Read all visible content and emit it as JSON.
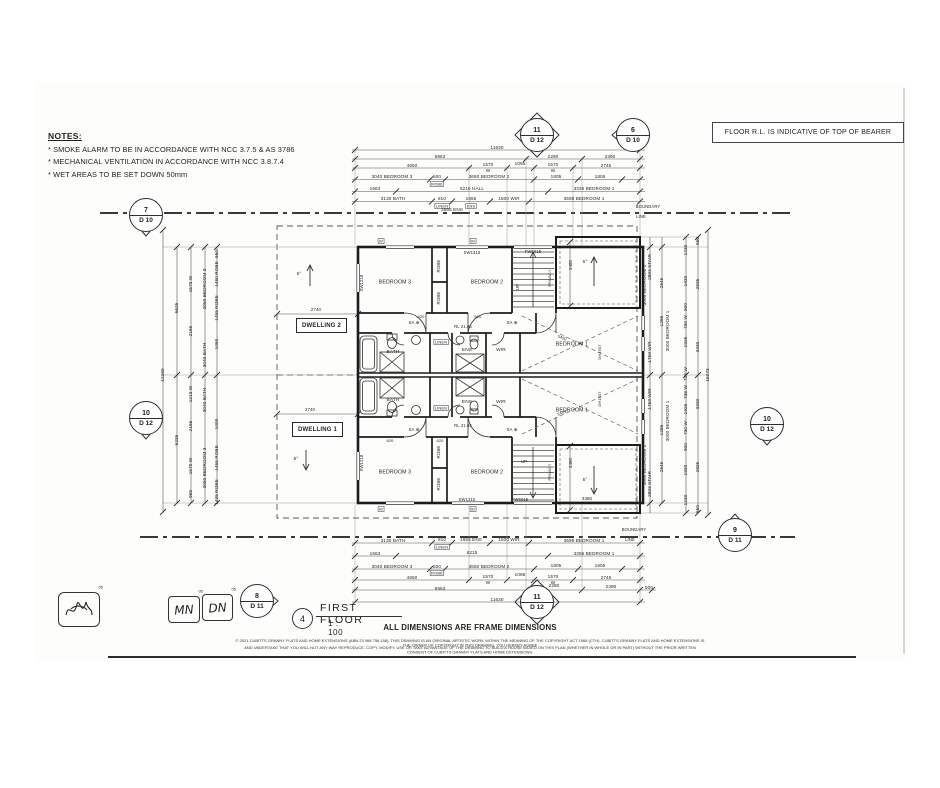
{
  "notes": {
    "title": "NOTES:",
    "lines": [
      "* SMOKE ALARM TO BE IN ACCORDANCE WITH NCC 3.7.5 & AS 3786",
      "* MECHANICAL VENTILATION IN ACCORDANCE WITH NCC 3.8.7.4",
      "* WET AREAS TO BE SET DOWN 50mm"
    ]
  },
  "floor_note": "FLOOR R.L. IS INDICATIVE OF TOP OF BEARER",
  "markers": [
    {
      "num": "11",
      "sheet": "D 12"
    },
    {
      "num": "6",
      "sheet": "D 10"
    },
    {
      "num": "7",
      "sheet": "D 10"
    },
    {
      "num": "10",
      "sheet": "D 12"
    },
    {
      "num": "10",
      "sheet": "D 12"
    },
    {
      "num": "9",
      "sheet": "D 11"
    },
    {
      "num": "11",
      "sheet": "D 12"
    },
    {
      "num": "8",
      "sheet": "D 11"
    }
  ],
  "plan": {
    "dwelling1": "DWELLING 1",
    "dwelling2": "DWELLING 2"
  },
  "stamps": {
    "initials_1": "MN",
    "initials_2": "DN",
    "tag": "05"
  },
  "title_block": {
    "number": "4",
    "title": "FIRST FLOOR",
    "scale": "1 : 100",
    "dims_note": "ALL DIMENSIONS ARE FRAME DIMENSIONS",
    "copyright_line1": "© 2021 CUBITTS GRANNY FLATS AND HOME EXTENSIONS (ABN 23 068 756 158). THIS DRAWING IS AN ORIGINAL ARTISTIC WORK WITHIN THE MEANING OF THE COPYRIGHT ACT 1968 (CTH). CUBITTS GRANNY FLATS AND HOME EXTENSIONS IS THE OWNER OF COPYRIGHT IN THIS DRAWING. YOU HEREBY AGREE",
    "copyright_line2": "AND UNDERTAKE THAT YOU WILL NOT ANY WAY REPRODUCE, COPY, MODIFY, USE OR TAKE ADVANTAGE OF THE DRAWING TO BUILD A HOUSE BASED ON THIS PLAN (WHETHER IN WHOLE OR IN PART) WITHOUT THE PRIOR WRITTEN CONSENT OF CUBITTS GRANNY FLATS AND HOME EXTENSIONS."
  },
  "annotations": [
    {
      "t": "11630",
      "x": 497,
      "y": 148
    },
    {
      "t": "6963",
      "x": 440,
      "y": 157
    },
    {
      "t": "2280",
      "x": 553,
      "y": 157
    },
    {
      "t": "2390",
      "x": 610,
      "y": 157
    },
    {
      "t": "4650",
      "x": 412,
      "y": 166
    },
    {
      "t": "1570",
      "x": 488,
      "y": 165
    },
    {
      "t": "W",
      "x": 488,
      "y": 171
    },
    {
      "t": "1095",
      "x": 520,
      "y": 164
    },
    {
      "t": "1570",
      "x": 553,
      "y": 165
    },
    {
      "t": "W",
      "x": 553,
      "y": 171
    },
    {
      "t": "2745",
      "x": 606,
      "y": 166
    },
    {
      "t": "3040 BEDROOM 3",
      "x": 392,
      "y": 177
    },
    {
      "t": "600",
      "x": 437,
      "y": 177
    },
    {
      "t": "ROBE",
      "x": 437,
      "y": 184,
      "bx": 1,
      "s": 4
    },
    {
      "t": "3650 BEDROOM 2",
      "x": 489,
      "y": 177
    },
    {
      "t": "1805",
      "x": 556,
      "y": 177
    },
    {
      "t": "1805",
      "x": 600,
      "y": 177
    },
    {
      "t": "1663",
      "x": 375,
      "y": 189
    },
    {
      "t": "6215 HALL",
      "x": 472,
      "y": 189
    },
    {
      "t": "3335 BEDROOM 1",
      "x": 594,
      "y": 189
    },
    {
      "t": "3130 BATH",
      "x": 393,
      "y": 199
    },
    {
      "t": "810",
      "x": 442,
      "y": 199
    },
    {
      "t": "LINEN",
      "x": 442,
      "y": 206,
      "bx": 1,
      "s": 4
    },
    {
      "t": "1555",
      "x": 471,
      "y": 199
    },
    {
      "t": "ENS",
      "x": 471,
      "y": 206,
      "bx": 1,
      "s": 4
    },
    {
      "t": "1600 WIR",
      "x": 509,
      "y": 199
    },
    {
      "t": "3695 BEDROOM 1",
      "x": 584,
      "y": 199
    },
    {
      "t": "2555 ENS",
      "x": 452,
      "y": 210
    },
    {
      "t": "3130 BATH",
      "x": 393,
      "y": 541
    },
    {
      "t": "810",
      "x": 442,
      "y": 540
    },
    {
      "t": "LINEN",
      "x": 442,
      "y": 547,
      "bx": 1,
      "s": 4
    },
    {
      "t": "1655 ENS",
      "x": 471,
      "y": 540
    },
    {
      "t": "1600 WIR",
      "x": 509,
      "y": 540
    },
    {
      "t": "3695 BEDROOM 1",
      "x": 584,
      "y": 541
    },
    {
      "t": "1663",
      "x": 375,
      "y": 554
    },
    {
      "t": "6215",
      "x": 472,
      "y": 553
    },
    {
      "t": "3395 BEDROOM 1",
      "x": 594,
      "y": 554
    },
    {
      "t": "3040 BEDROOM 3",
      "x": 392,
      "y": 567
    },
    {
      "t": "600",
      "x": 437,
      "y": 567
    },
    {
      "t": "ROBE",
      "x": 437,
      "y": 573,
      "bx": 1,
      "s": 4
    },
    {
      "t": "3650 BEDROOM 2",
      "x": 489,
      "y": 567
    },
    {
      "t": "1805",
      "x": 556,
      "y": 566
    },
    {
      "t": "1805",
      "x": 600,
      "y": 566
    },
    {
      "t": "4650",
      "x": 412,
      "y": 578
    },
    {
      "t": "1570",
      "x": 488,
      "y": 577
    },
    {
      "t": "W",
      "x": 488,
      "y": 583
    },
    {
      "t": "1095",
      "x": 520,
      "y": 575
    },
    {
      "t": "1570",
      "x": 553,
      "y": 577
    },
    {
      "t": "W",
      "x": 553,
      "y": 583
    },
    {
      "t": "2745",
      "x": 606,
      "y": 578
    },
    {
      "t": "6963",
      "x": 440,
      "y": 589
    },
    {
      "t": "2280",
      "x": 554,
      "y": 586
    },
    {
      "t": "2390",
      "x": 611,
      "y": 587
    },
    {
      "t": "500",
      "x": 649,
      "y": 588
    },
    {
      "t": "11630",
      "x": 497,
      "y": 600
    },
    {
      "t": "12369",
      "x": 163,
      "y": 375,
      "r": -90
    },
    {
      "t": "6625",
      "x": 177,
      "y": 308,
      "r": -90
    },
    {
      "t": "6235",
      "x": 177,
      "y": 440,
      "r": -90
    },
    {
      "t": "560",
      "x": 217,
      "y": 254,
      "r": -90
    },
    {
      "t": "1480 ROBE",
      "x": 217,
      "y": 274,
      "r": -90
    },
    {
      "t": "1573 W",
      "x": 191,
      "y": 284,
      "r": -90
    },
    {
      "t": "3050 BEDROOM 3",
      "x": 205,
      "y": 289,
      "r": -90
    },
    {
      "t": "1455 ROBE",
      "x": 217,
      "y": 308,
      "r": -90
    },
    {
      "t": "2165",
      "x": 191,
      "y": 331,
      "r": -90
    },
    {
      "t": "1060",
      "x": 217,
      "y": 344,
      "r": -90
    },
    {
      "t": "3040 BATH",
      "x": 205,
      "y": 355,
      "r": -90
    },
    {
      "t": "1213 W",
      "x": 191,
      "y": 394,
      "r": -90
    },
    {
      "t": "3040 BATH",
      "x": 205,
      "y": 400,
      "r": -90
    },
    {
      "t": "1000",
      "x": 217,
      "y": 424,
      "r": -90
    },
    {
      "t": "2165",
      "x": 191,
      "y": 426,
      "r": -90
    },
    {
      "t": "1455 ROBE",
      "x": 217,
      "y": 458,
      "r": -90
    },
    {
      "t": "1570 W",
      "x": 191,
      "y": 466,
      "r": -90
    },
    {
      "t": "3050 BEDROOM 3",
      "x": 205,
      "y": 468,
      "r": -90
    },
    {
      "t": "1435 ROBE",
      "x": 217,
      "y": 492,
      "r": -90
    },
    {
      "t": "968",
      "x": 191,
      "y": 494,
      "r": -90
    },
    {
      "t": "15273",
      "x": 708,
      "y": 375,
      "r": -90
    },
    {
      "t": "650",
      "x": 698,
      "y": 241,
      "r": -90
    },
    {
      "t": "1230",
      "x": 686,
      "y": 250,
      "r": -90
    },
    {
      "t": "2893 STAIR",
      "x": 650,
      "y": 267,
      "r": -90
    },
    {
      "t": "3000 BEDROOM 2",
      "x": 645,
      "y": 285,
      "r": -90
    },
    {
      "t": "2845",
      "x": 662,
      "y": 283,
      "r": -90
    },
    {
      "t": "1930",
      "x": 686,
      "y": 281,
      "r": -90
    },
    {
      "t": "2835",
      "x": 698,
      "y": 284,
      "r": -90
    },
    {
      "t": "900",
      "x": 686,
      "y": 307,
      "r": -90
    },
    {
      "t": "1286",
      "x": 662,
      "y": 321,
      "r": -90
    },
    {
      "t": "730 W",
      "x": 686,
      "y": 322,
      "r": -90
    },
    {
      "t": "3000 BEDROOM 1",
      "x": 668,
      "y": 331,
      "r": -90
    },
    {
      "t": "1926",
      "x": 686,
      "y": 342,
      "r": -90
    },
    {
      "t": "3330",
      "x": 698,
      "y": 347,
      "r": -90
    },
    {
      "t": "1759 WIR",
      "x": 650,
      "y": 352,
      "r": -90
    },
    {
      "t": "716 W",
      "x": 686,
      "y": 374,
      "r": -90
    },
    {
      "t": "738 W",
      "x": 686,
      "y": 392,
      "r": -90
    },
    {
      "t": "1759 WIR",
      "x": 650,
      "y": 399,
      "r": -90
    },
    {
      "t": "3330",
      "x": 698,
      "y": 404,
      "r": -90
    },
    {
      "t": "1926",
      "x": 686,
      "y": 409,
      "r": -90
    },
    {
      "t": "3000 BEDROOM 1",
      "x": 668,
      "y": 421,
      "r": -90
    },
    {
      "t": "730 W",
      "x": 686,
      "y": 428,
      "r": -90
    },
    {
      "t": "1286",
      "x": 662,
      "y": 430,
      "r": -90
    },
    {
      "t": "900",
      "x": 686,
      "y": 447,
      "r": -90
    },
    {
      "t": "3000 BEDROOM 2",
      "x": 645,
      "y": 465,
      "r": -90
    },
    {
      "t": "2845",
      "x": 662,
      "y": 467,
      "r": -90
    },
    {
      "t": "1930",
      "x": 686,
      "y": 470,
      "r": -90
    },
    {
      "t": "2835",
      "x": 698,
      "y": 467,
      "r": -90
    },
    {
      "t": "2893 STAIR",
      "x": 650,
      "y": 484,
      "r": -90
    },
    {
      "t": "1230",
      "x": 686,
      "y": 500,
      "r": -90
    },
    {
      "t": "650",
      "x": 698,
      "y": 509,
      "r": -90
    },
    {
      "t": "BEDROOM 3",
      "x": 395,
      "y": 282,
      "s": 5.2,
      "n": "room-label-bedroom3"
    },
    {
      "t": "BEDROOM 2",
      "x": 487,
      "y": 282,
      "s": 5.2,
      "n": "room-label-bedroom2"
    },
    {
      "t": "BEDROOM 1",
      "x": 572,
      "y": 344,
      "s": 5.2,
      "n": "room-label-bedroom1"
    },
    {
      "t": "ROBE",
      "x": 439,
      "y": 266,
      "r": -90,
      "s": 4.4,
      "n": "room-label-robe"
    },
    {
      "t": "ROBE",
      "x": 439,
      "y": 298,
      "r": -90,
      "s": 4.4,
      "n": "room-label-robe"
    },
    {
      "t": "BATH",
      "x": 393,
      "y": 352,
      "s": 4.8,
      "n": "room-label-bath"
    },
    {
      "t": "ENS",
      "x": 467,
      "y": 350,
      "s": 4.8,
      "n": "room-label-ens"
    },
    {
      "t": "WIR",
      "x": 501,
      "y": 350,
      "s": 4.8,
      "n": "room-label-wir"
    },
    {
      "t": "LINEN",
      "x": 441,
      "y": 342,
      "bx": 1,
      "s": 4,
      "n": "room-label-linen"
    },
    {
      "t": "SA ⊕",
      "x": 414,
      "y": 323,
      "s": 4.4,
      "n": "smoke-alarm-symbol"
    },
    {
      "t": "SA ⊕",
      "x": 512,
      "y": 323,
      "s": 4.4,
      "n": "smoke-alarm-symbol"
    },
    {
      "t": "RL 21.65",
      "x": 463,
      "y": 327,
      "s": 4.2
    },
    {
      "t": "620",
      "x": 421,
      "y": 317,
      "s": 4
    },
    {
      "t": "820",
      "x": 478,
      "y": 317,
      "s": 4
    },
    {
      "t": "BEDROOM 3",
      "x": 395,
      "y": 472,
      "s": 5.2,
      "n": "room-label-bedroom3"
    },
    {
      "t": "BEDROOM 2",
      "x": 487,
      "y": 472,
      "s": 5.2,
      "n": "room-label-bedroom2"
    },
    {
      "t": "BEDROOM 1",
      "x": 572,
      "y": 410,
      "s": 5.2,
      "n": "room-label-bedroom1"
    },
    {
      "t": "ROBE",
      "x": 439,
      "y": 452,
      "r": -90,
      "s": 4.4,
      "n": "room-label-robe"
    },
    {
      "t": "ROBE",
      "x": 439,
      "y": 484,
      "r": -90,
      "s": 4.4,
      "n": "room-label-robe"
    },
    {
      "t": "BATH",
      "x": 393,
      "y": 400,
      "s": 4.8,
      "n": "room-label-bath"
    },
    {
      "t": "ENS",
      "x": 467,
      "y": 402,
      "s": 4.8,
      "n": "room-label-ens"
    },
    {
      "t": "WIR",
      "x": 501,
      "y": 402,
      "s": 4.8,
      "n": "room-label-wir"
    },
    {
      "t": "LINEN",
      "x": 441,
      "y": 408,
      "bx": 1,
      "s": 4,
      "n": "room-label-linen"
    },
    {
      "t": "SA ⊕",
      "x": 414,
      "y": 430,
      "s": 4.4,
      "n": "smoke-alarm-symbol"
    },
    {
      "t": "SA ⊕",
      "x": 512,
      "y": 430,
      "s": 4.4,
      "n": "smoke-alarm-symbol"
    },
    {
      "t": "RL 21.65",
      "x": 463,
      "y": 426,
      "s": 4.2
    },
    {
      "t": "820",
      "x": 390,
      "y": 441,
      "s": 4
    },
    {
      "t": "620",
      "x": 440,
      "y": 441,
      "s": 4
    },
    {
      "t": "UP",
      "x": 518,
      "y": 287,
      "r": -90,
      "s": 4.4,
      "n": "stair-up-label"
    },
    {
      "t": "UP",
      "x": 524,
      "y": 462,
      "s": 4.4,
      "n": "stair-up-label"
    },
    {
      "t": "PRIVACY",
      "x": 550,
      "y": 278,
      "r": -90,
      "s": 3.8
    },
    {
      "t": "PRIVACY",
      "x": 550,
      "y": 472,
      "r": -90,
      "s": 3.8
    },
    {
      "t": "SW1315",
      "x": 472,
      "y": 253,
      "s": 4.2,
      "n": "window-label"
    },
    {
      "t": "FW6015",
      "x": 533,
      "y": 252,
      "s": 4.2,
      "n": "window-label"
    },
    {
      "t": "SW1215",
      "x": 467,
      "y": 500,
      "s": 4.2,
      "n": "window-label"
    },
    {
      "t": "FW6015",
      "x": 520,
      "y": 500,
      "s": 4.2,
      "n": "window-label"
    },
    {
      "t": "SW1218",
      "x": 362,
      "y": 283,
      "r": -90,
      "s": 4.2,
      "n": "window-label"
    },
    {
      "t": "SW1218",
      "x": 362,
      "y": 463,
      "r": -90,
      "s": 4.2,
      "n": "window-label"
    },
    {
      "t": "DH1907",
      "x": 600,
      "y": 352,
      "r": -90,
      "s": 4,
      "n": "window-label"
    },
    {
      "t": "DH1907",
      "x": 600,
      "y": 399,
      "r": -90,
      "s": 4,
      "n": "window-label"
    },
    {
      "t": "5450",
      "x": 562,
      "y": 338,
      "r": 23,
      "s": 4
    },
    {
      "t": "5450",
      "x": 562,
      "y": 413,
      "r": -23,
      "s": 4
    },
    {
      "t": "3480",
      "x": 571,
      "y": 265,
      "r": -90,
      "s": 4.4
    },
    {
      "t": "3480",
      "x": 571,
      "y": 463,
      "r": -90,
      "s": 4.4
    },
    {
      "t": "3380",
      "x": 587,
      "y": 499,
      "s": 4.4
    },
    {
      "t": "5°",
      "x": 585,
      "y": 262,
      "s": 4.6,
      "n": "roof-slope-label"
    },
    {
      "t": "5°",
      "x": 585,
      "y": 480,
      "s": 4.6,
      "n": "roof-slope-label"
    },
    {
      "t": "5°",
      "x": 299,
      "y": 274,
      "s": 4.6,
      "n": "roof-slope-label"
    },
    {
      "t": "5°",
      "x": 296,
      "y": 459,
      "s": 4.6,
      "n": "roof-slope-label"
    },
    {
      "t": "2740",
      "x": 316,
      "y": 310,
      "s": 4.4
    },
    {
      "t": "2740",
      "x": 310,
      "y": 410,
      "s": 4.4
    },
    {
      "t": "W",
      "x": 381,
      "y": 241,
      "bx": 1,
      "s": 4,
      "n": "window-tag"
    },
    {
      "t": "W",
      "x": 473,
      "y": 241,
      "bx": 1,
      "s": 4,
      "n": "window-tag"
    },
    {
      "t": "W",
      "x": 381,
      "y": 509,
      "bx": 1,
      "s": 4,
      "n": "window-tag"
    },
    {
      "t": "W",
      "x": 473,
      "y": 509,
      "bx": 1,
      "s": 4,
      "n": "window-tag"
    },
    {
      "t": "BOUNDARY",
      "x": 648,
      "y": 207,
      "s": 4.2,
      "n": "boundary-label"
    },
    {
      "t": "LINE",
      "x": 641,
      "y": 217,
      "s": 4.2,
      "n": "boundary-label"
    },
    {
      "t": "BOUNDARY",
      "x": 634,
      "y": 530,
      "s": 4.2,
      "n": "boundary-label"
    },
    {
      "t": "LINE",
      "x": 630,
      "y": 540,
      "s": 4.2,
      "n": "boundary-label"
    }
  ]
}
